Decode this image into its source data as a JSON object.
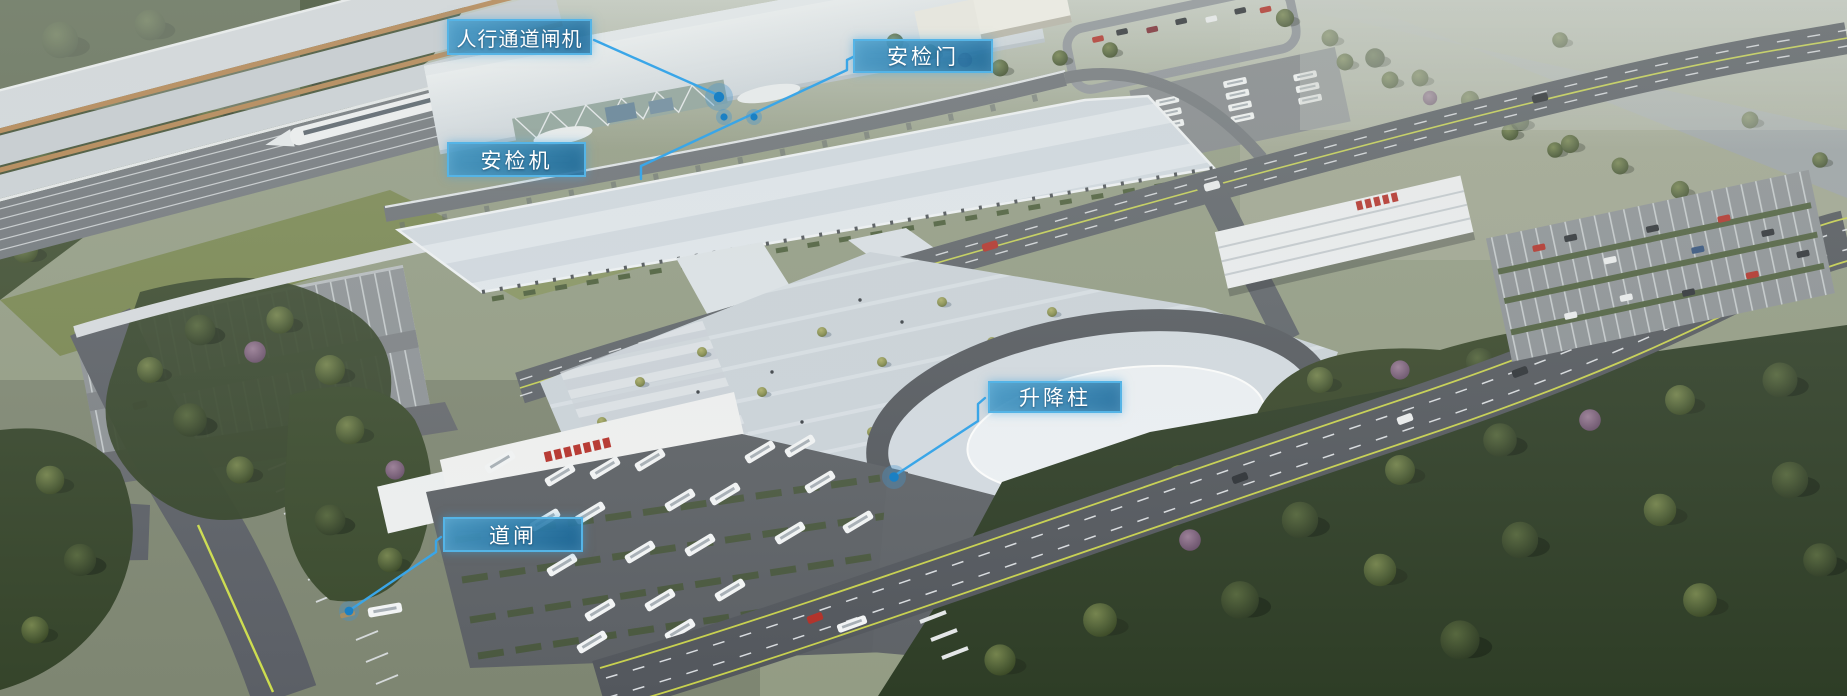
{
  "annotations": {
    "labels": [
      {
        "id": "pedestrian-channel-gate",
        "text": "人行通道闸机"
      },
      {
        "id": "security-door",
        "text": "安检门"
      },
      {
        "id": "security-scanner",
        "text": "安检机"
      },
      {
        "id": "lifting-bollard",
        "text": "升降柱"
      },
      {
        "id": "road-barrier-gate",
        "text": "道闸"
      }
    ],
    "style": {
      "label_background": "#1b78b2",
      "label_border": "#55b4e6",
      "leader_line": "#3aa6e8",
      "marker_fill": "#1a80c4",
      "label_text_color": "#ffffff"
    }
  }
}
